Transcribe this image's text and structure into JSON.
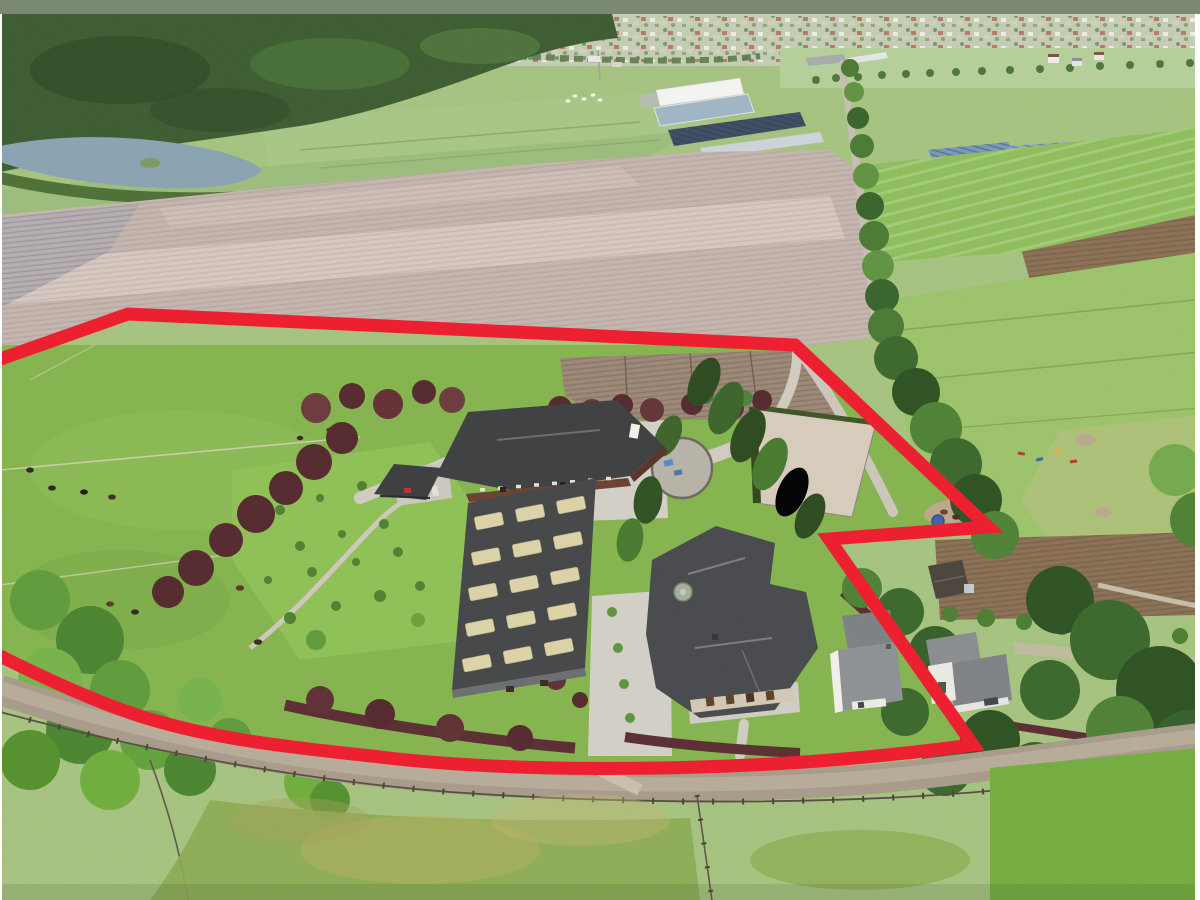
{
  "photo": {
    "width": 1200,
    "height": 900,
    "top_haze_color": "#7b8874",
    "margin_color": "#ffffff"
  },
  "boundary": {
    "color": "#ee1c2d",
    "stroke_width": 13,
    "path_d": "M -8,362 L 128,314 L 795,345 L 988,527 L 829,539 L 973,745 C 880,757 800,764 700,767 C 600,770 480,769 380,757 C 300,748 220,741 143,717 C 95,702 40,676 -8,652"
  },
  "palette": {
    "plowed_field": "#c6b5af",
    "plowed_light": "#d9cbc4",
    "gray_field": "#b5aeb2",
    "pasture": "#84b44e",
    "south_pasture": "#8cab52",
    "meadow": "#a8c687",
    "village_band": "#c4cdb4",
    "forest": "#3c5c31",
    "lake": "#8aa3b2",
    "east_field": "#8fbe5c",
    "arena_sand": "#d8cdbc",
    "concrete": "#d3d0c7",
    "road": "#a89b8a",
    "stable_roof": "#3d3f41",
    "barn_roof": "#454648",
    "house_roof": "#47494c",
    "beech_hedge": "#54292e",
    "canopy": "#3a682c",
    "solar_blue": "#7a98b8",
    "brown_strip": "#8b7054"
  },
  "animals": {
    "cattle": [
      [
        30,
        470,
        2.6,
        "#2e2620"
      ],
      [
        52,
        488,
        2.6,
        "#2e2620"
      ],
      [
        84,
        492,
        2.6,
        "#1f1a16"
      ],
      [
        112,
        497,
        2.6,
        "#3a2c20"
      ],
      [
        240,
        588,
        2.8,
        "#5a3a22"
      ],
      [
        258,
        642,
        2.8,
        "#3a2c20"
      ],
      [
        110,
        604,
        2.6,
        "#5a3a22"
      ],
      [
        135,
        612,
        2.6,
        "#2e2620"
      ],
      [
        330,
        430,
        2.4,
        "#4a3020"
      ],
      [
        300,
        438,
        2.2,
        "#2e2620"
      ]
    ],
    "sheep": [
      [
        575,
        96,
        1.6,
        "#f5f5f0"
      ],
      [
        584,
        99,
        1.6,
        "#f5f5f0"
      ],
      [
        593,
        95,
        1.6,
        "#f5f5f0"
      ],
      [
        600,
        100,
        1.6,
        "#f5f5f0"
      ],
      [
        568,
        101,
        1.6,
        "#f5f5f0"
      ]
    ],
    "horses": [
      [
        944,
        512,
        2.6,
        "#6b4426"
      ],
      [
        956,
        517,
        2.6,
        "#4a2f1a"
      ],
      [
        966,
        511,
        2.6,
        "#6b4426"
      ]
    ]
  }
}
